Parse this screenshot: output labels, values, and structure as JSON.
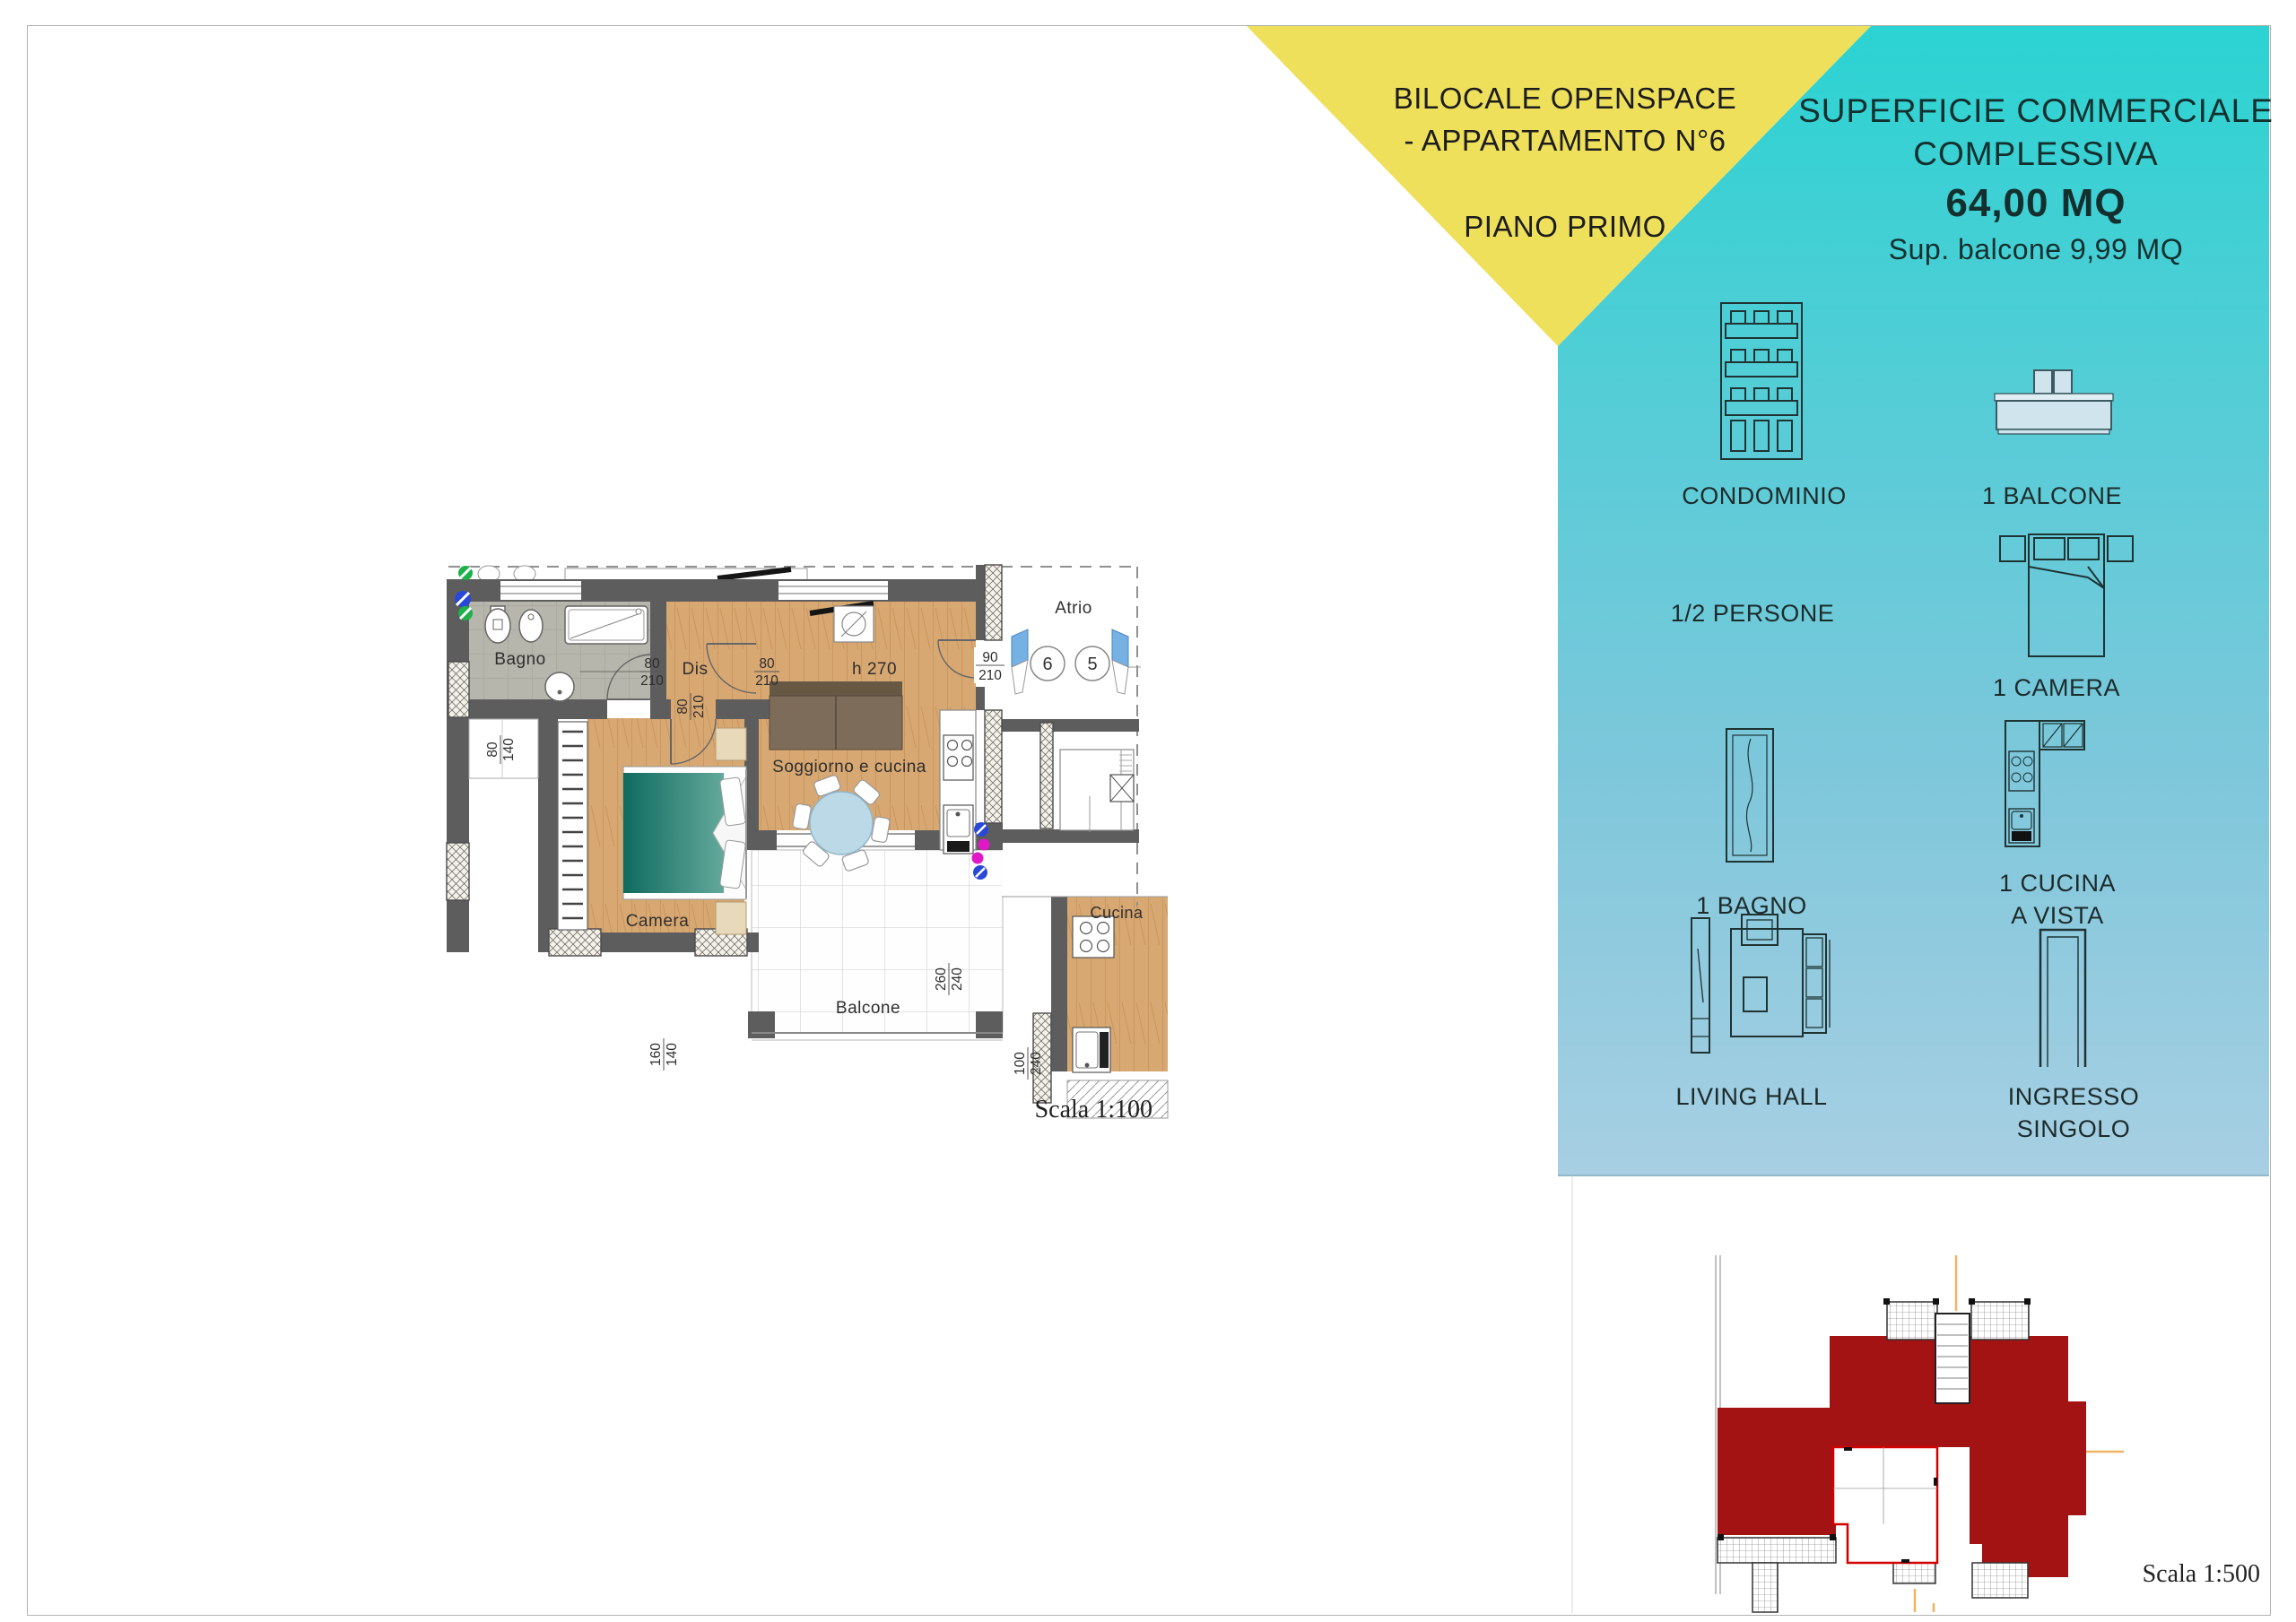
{
  "header": {
    "title_line1": "BILOCALE OPENSPACE",
    "title_line2": "- APPARTAMENTO N°6",
    "subtitle": "PIANO PRIMO",
    "triangle_color": "#EFE05C"
  },
  "summary_panel": {
    "title_line1": "SUPERFICIE COMMERCIALE",
    "title_line2": "COMPLESSIVA",
    "area_value": "64,00 MQ",
    "balcony_note": "Sup. balcone 9,99  MQ",
    "gradient_top": "#2BD3D2",
    "gradient_bottom": "#A8CFE3",
    "features": [
      {
        "icon": "condominio-icon",
        "label": "CONDOMINIO"
      },
      {
        "icon": "balcone-icon",
        "label": "1 BALCONE"
      },
      {
        "icon": "persone-icon",
        "label": "1/2 PERSONE"
      },
      {
        "icon": "camera-icon",
        "label": "1 CAMERA"
      },
      {
        "icon": "bagno-icon",
        "label": "1 BAGNO"
      },
      {
        "icon": "cucina-icon",
        "label": "1 CUCINA",
        "label2": "A VISTA"
      },
      {
        "icon": "living-icon",
        "label": "LIVING HALL"
      },
      {
        "icon": "ingresso-icon",
        "label": "INGRESSO SINGOLO"
      }
    ]
  },
  "floor_plan": {
    "scale_label": "Scala 1:100",
    "rooms": {
      "bagno": "Bagno",
      "dis": "Dis",
      "camera": "Camera",
      "soggiorno": "Soggiorno e cucina",
      "ceiling_height": "h 270",
      "balcone": "Balcone",
      "atrio": "Atrio",
      "cucina_adjacent": "Cucina"
    },
    "unit_numbers": [
      "6",
      "5"
    ],
    "dimensions": {
      "bagno_door": [
        "80",
        "210"
      ],
      "camera_door": [
        "80",
        "210"
      ],
      "soggiorno_door": [
        "80",
        "210"
      ],
      "entrance_door": [
        "90",
        "210"
      ],
      "bagno_window": [
        "80",
        "140"
      ],
      "camera_window": [
        "160",
        "140"
      ],
      "soggiorno_window": [
        "260",
        "240"
      ],
      "cucina_window": [
        "100",
        "240"
      ]
    }
  },
  "site_plan": {
    "scale_label": "Scala 1:500",
    "building_color": "#A31313"
  }
}
